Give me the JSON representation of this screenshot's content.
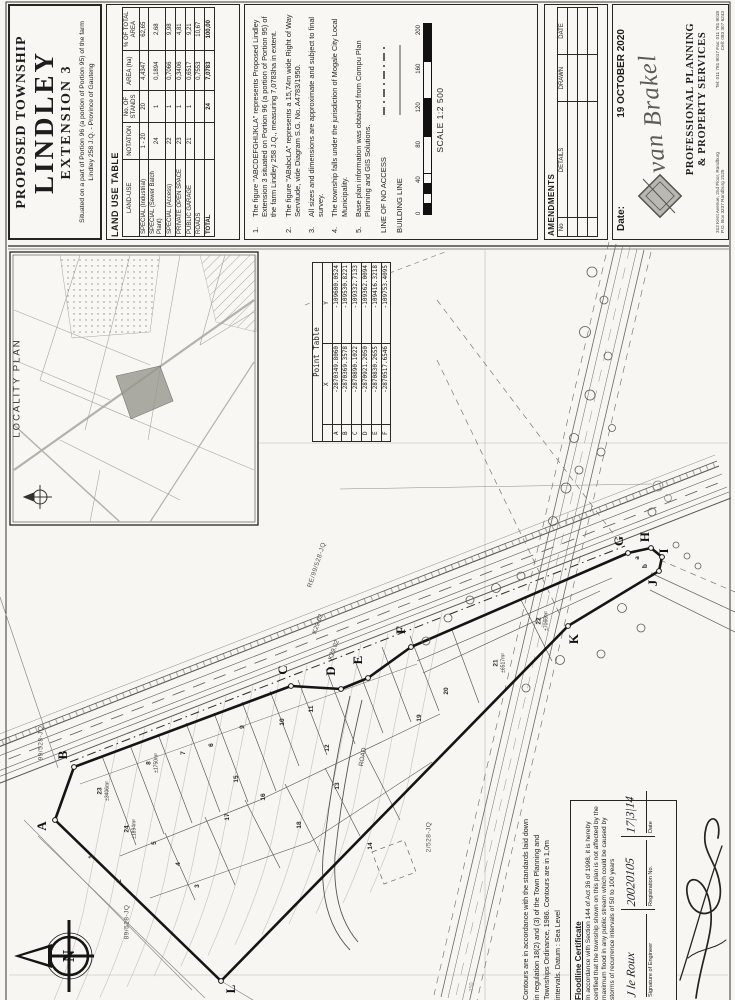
{
  "title_block": {
    "line1": "PROPOSED TOWNSHIP",
    "line2": "LINDLEY",
    "line3": "EXTENSION 3",
    "subtitle": "Situated on a part of Portion 96 (a portion of Portion 95) of the farm Lindley 258 J.Q. - Province of Gauteng"
  },
  "land_use_table": {
    "title": "LAND USE TABLE",
    "columns": [
      "LAND-USE",
      "NOTATION",
      "No. OF STANDS",
      "AREA (ha)",
      "% OF TOTAL AREA"
    ],
    "rows": [
      [
        "SPECIAL (Industrial)",
        "1 - 20",
        "20",
        "4,4347",
        "62,65"
      ],
      [
        "SPECIAL (Sewer Batch Plant)",
        "24",
        "1",
        "0,1894",
        "2,68"
      ],
      [
        "SPECIAL (Access)",
        "22",
        "1",
        "0,7066",
        "9,98"
      ],
      [
        "PRIVATE OPEN SPACE",
        "23",
        "1",
        "0,3406",
        "4,81"
      ],
      [
        "PUBLIC GARAGE",
        "21",
        "1",
        "0,6517",
        "9,21"
      ],
      [
        "ROADS",
        "",
        "",
        "0,7553",
        "10,67"
      ]
    ],
    "total_row": [
      "TOTAL",
      "",
      "24",
      "7,0783",
      "100,00"
    ]
  },
  "notes": [
    "The figure \"ABCDEFGHIJKLA\" represents Proposed Lindley  Extension 3 situated on Portion 96 (a portion of Portion 95) of the farm Lindley 258 J.Q., measuring 7,0783ha  in extent.",
    "The figure \"ABabcLA\" represents a 15,74m wide Right of Way Servitude, vide Diagram S.G. No. A4783/1950.",
    "All sizes and dimensions are approximate and subject to final survey.",
    "The township falls under the jurisdiction of Mogale City Local Municipality.",
    "Base plan information was obtained from Compu Plan Planning and GIS Solutions."
  ],
  "legend": [
    {
      "label": "LINE OF NO ACCESS",
      "style": "dash-dot"
    },
    {
      "label": "BUILDING LINE",
      "style": "solid"
    }
  ],
  "scale": {
    "ticks": [
      "0",
      "40",
      "80",
      "120",
      "160",
      "200"
    ],
    "label": "SCALE 1:2 500"
  },
  "amendments": {
    "title": "AMENDMENTS",
    "columns": [
      "No",
      "DETAILS",
      "DRAWN",
      "DATE"
    ]
  },
  "firm": {
    "date_label": "Date:",
    "date_value": "19 OCTOBER 2020",
    "name": "van Brakel",
    "line1": "PROFESSIONAL  PLANNING",
    "line2": "&  PROPERTY   SERVICES",
    "address1": "312 Kent Avenue, 2nd Floor, Randburg",
    "address2": "P.O. Box 3237 Randburg 2125",
    "tel": "Tel: 011 781 9017   Fax: 011 781 9018",
    "cell": "Cell: 083 307 6243"
  },
  "point_table": {
    "title": "Point Table",
    "columns": [
      "",
      "X",
      "Y"
    ],
    "rows": [
      [
        "A",
        "-2870349.8060",
        "-109600.0524"
      ],
      [
        "B",
        "-2870369.3578",
        "-109530.8221"
      ],
      [
        "C",
        "-2870890.1022",
        "-109332.7133"
      ],
      [
        "D",
        "-2870921.2050",
        "-109362.0094"
      ],
      [
        "E",
        "-2870830.2655",
        "-109416.3218"
      ],
      [
        "F",
        "-2870517.6546",
        "-109753.4095"
      ]
    ]
  },
  "map": {
    "locality_label": "LOCALITY PLAN",
    "north_letter": "N",
    "boundary_letters": [
      {
        "t": "A",
        "x": 42,
        "y": 826
      },
      {
        "t": "B",
        "x": 63,
        "y": 755
      },
      {
        "t": "C",
        "x": 283,
        "y": 670
      },
      {
        "t": "D",
        "x": 331,
        "y": 671
      },
      {
        "t": "E",
        "x": 358,
        "y": 660
      },
      {
        "t": "F",
        "x": 401,
        "y": 630
      },
      {
        "t": "G",
        "x": 619,
        "y": 541
      },
      {
        "t": "H",
        "x": 645,
        "y": 537
      },
      {
        "t": "I",
        "x": 664,
        "y": 551
      },
      {
        "t": "J",
        "x": 653,
        "y": 583
      },
      {
        "t": "K",
        "x": 574,
        "y": 639
      },
      {
        "t": "L",
        "x": 231,
        "y": 989
      }
    ],
    "servitude_letters": [
      {
        "t": "a",
        "x": 637,
        "y": 558
      },
      {
        "t": "b",
        "x": 645,
        "y": 566
      },
      {
        "t": "c",
        "x": 653,
        "y": 574
      }
    ],
    "road_labels": [
      {
        "t": "K29.02",
        "x": 318,
        "y": 624,
        "r": -70
      },
      {
        "t": "K29.02",
        "x": 334,
        "y": 650,
        "r": -70
      }
    ],
    "parcel_labels": [
      {
        "t": "RE/99/528-JQ",
        "x": 317,
        "y": 565,
        "r": -72
      },
      {
        "t": "99/528-JQ",
        "x": 41,
        "y": 743,
        "r": -90
      },
      {
        "t": "89/528-JQ",
        "x": 127,
        "y": 922,
        "r": -90
      },
      {
        "t": "2/528-JQ",
        "x": 429,
        "y": 837,
        "r": -90
      }
    ],
    "internal_road_label": {
      "t": "ROAD",
      "x": 363,
      "y": 757,
      "r": -80
    },
    "grid_label": {
      "t": "750",
      "x": 472,
      "y": 987,
      "r": -90
    },
    "lots": [
      {
        "n": "1",
        "x": 92,
        "y": 857
      },
      {
        "n": "2",
        "x": 120,
        "y": 881
      },
      {
        "n": "3",
        "x": 198,
        "y": 886
      },
      {
        "n": "4",
        "x": 179,
        "y": 864
      },
      {
        "n": "5",
        "x": 155,
        "y": 843
      },
      {
        "n": "6",
        "x": 212,
        "y": 745
      },
      {
        "n": "7",
        "x": 184,
        "y": 753
      },
      {
        "n": "8",
        "a": "±1750m²",
        "x": 153,
        "y": 763
      },
      {
        "n": "9",
        "x": 243,
        "y": 727
      },
      {
        "n": "10",
        "x": 283,
        "y": 722
      },
      {
        "n": "11",
        "x": 312,
        "y": 709
      },
      {
        "n": "12",
        "x": 328,
        "y": 748
      },
      {
        "n": "13",
        "x": 338,
        "y": 786
      },
      {
        "n": "14",
        "x": 371,
        "y": 846
      },
      {
        "n": "15",
        "x": 237,
        "y": 779
      },
      {
        "n": "16",
        "x": 264,
        "y": 797
      },
      {
        "n": "17",
        "x": 228,
        "y": 817
      },
      {
        "n": "18",
        "x": 300,
        "y": 825
      },
      {
        "n": "19",
        "x": 420,
        "y": 718
      },
      {
        "n": "20",
        "x": 447,
        "y": 691
      },
      {
        "n": "21",
        "a": "±6517m²",
        "x": 500,
        "y": 663
      },
      {
        "n": "22",
        "a": "±7066m²",
        "x": 543,
        "y": 621
      },
      {
        "n": "23",
        "a": "±3406m²",
        "x": 104,
        "y": 791
      },
      {
        "n": "24",
        "a": "±1894m²",
        "x": 131,
        "y": 829
      }
    ]
  },
  "certificate": {
    "contour_lines": [
      "Contours are in accordance with the standards laid down",
      "in regulation 18(2) and (3) of the Town Planning and",
      "Townships Ordinance, 1986. Contours are in 1,0m",
      "intervals. Datum : Sea Level"
    ],
    "floodline": {
      "heading": "Floodline Certificate",
      "body": "In accordance with Section 144 of Act 36 of 1998, it is hereby certified that the township shown on this plan is not affected by the maximum flood in any public stream which could be caused by storms of recurrence intervals of 50 to 100 years",
      "sig_labels": [
        "Signature of Engineer",
        "Registration No.",
        "Date"
      ],
      "sig_values": [
        "J le Roux",
        "20020105",
        "17|3|14"
      ]
    }
  }
}
